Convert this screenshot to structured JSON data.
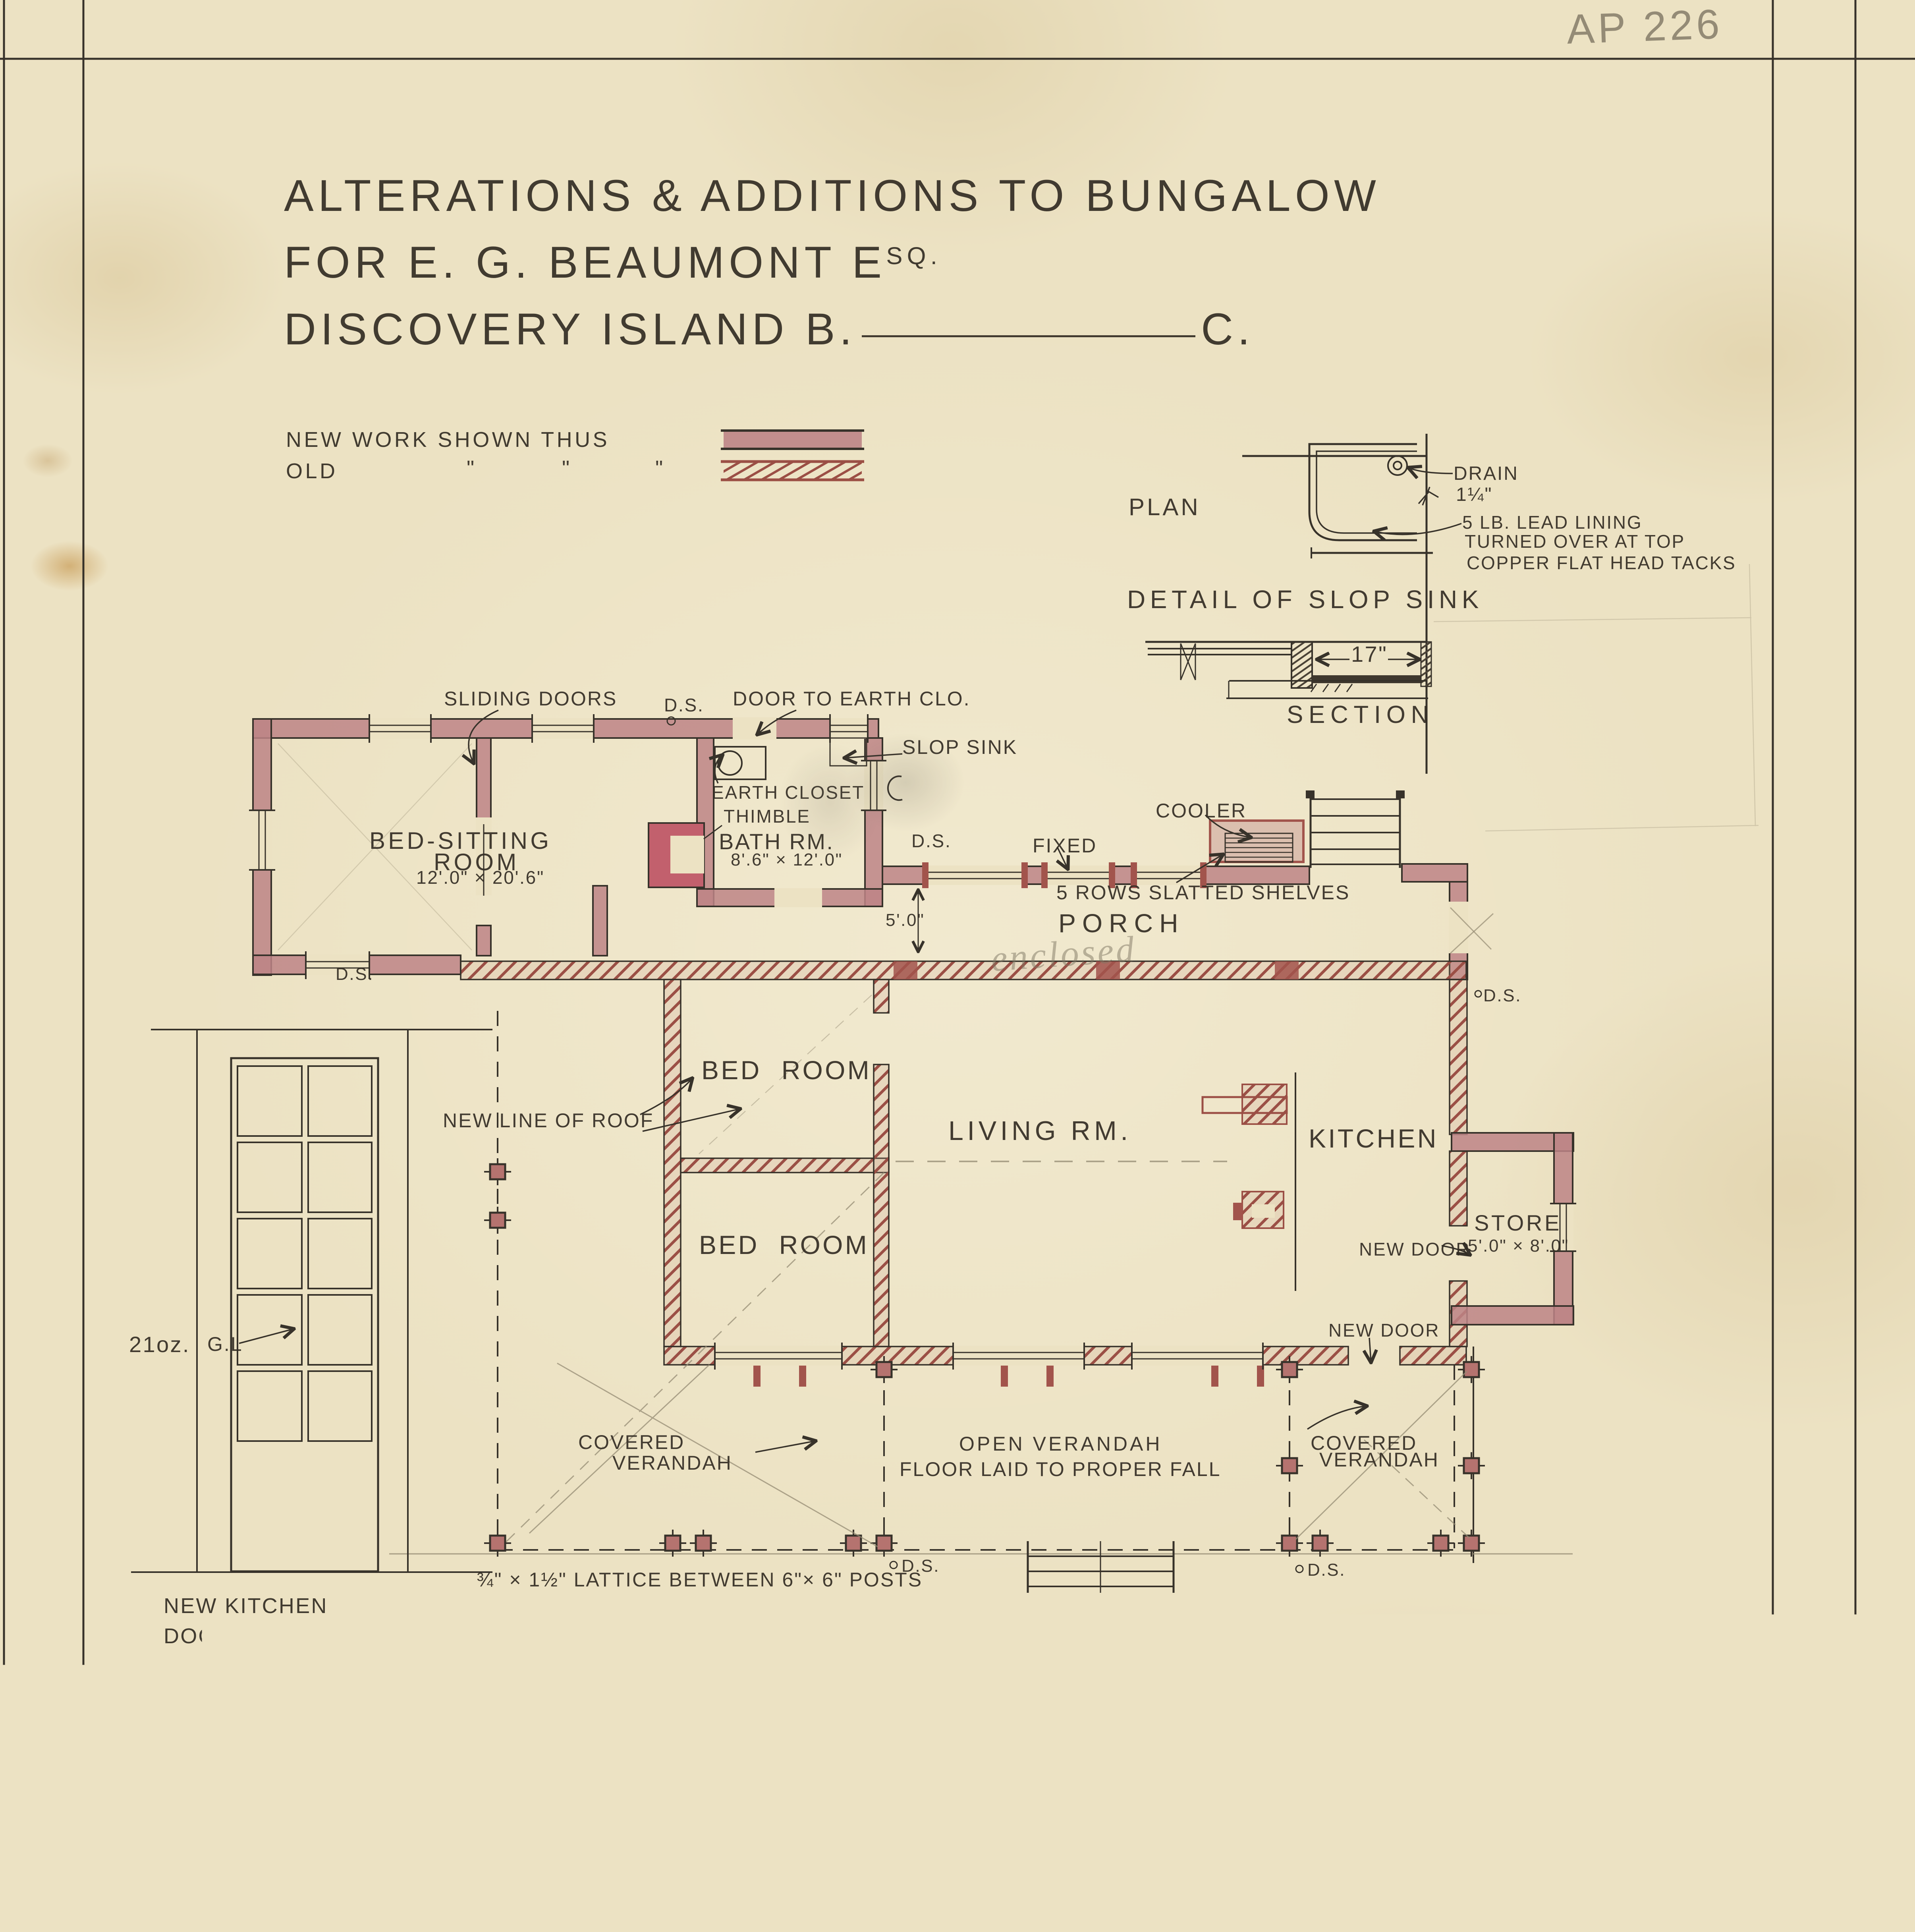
{
  "sheet": {
    "archive_no_pencil": "AP 226",
    "archive_no_stamp": "A.P. 226",
    "parks_note": "Parks Branch",
    "museum_stamp_line1": "MALTWOOD MEMORIAL MUSEUM",
    "museum_stamp_line2": "OF HISTORIC ART"
  },
  "title": {
    "line1": "ALTERATIONS & ADDITIONS TO BUNGALOW",
    "line2_main": "FOR E. G. BEAUMONT E",
    "line2_sup": "SQ.",
    "line3_left": "DISCOVERY ISLAND B.",
    "line3_right": "C."
  },
  "legend": {
    "new_label": "NEW WORK SHOWN THUS",
    "old_label": "OLD",
    "ditto": "\""
  },
  "slop_sink_detail": {
    "plan_label": "PLAN",
    "drain": "DRAIN",
    "pipe_size": "1¼\"",
    "note1": "5 LB. LEAD LINING",
    "note2": "TURNED OVER AT TOP",
    "note3": "COPPER FLAT HEAD TACKS",
    "heading": "DETAIL OF SLOP SINK",
    "width_dim": "17\"",
    "section_label": "SECTION"
  },
  "plan": {
    "sliding_doors": "SLIDING DOORS",
    "ds": "D.S.",
    "door_to_earth_closet": "DOOR TO EARTH CLO.",
    "slop_sink": "SLOP SINK",
    "earth_closet": "EARTH CLOSET",
    "thimble": "THIMBLE",
    "bed_sitting_room_1": "BED-SITTING",
    "bed_sitting_room_2": "ROOM",
    "bed_sitting_dim": "12'.0\" × 20'.6\"",
    "bath_room": "BATH RM.",
    "bath_dim": "8'.6\" × 12'.0\"",
    "fixed": "FIXED",
    "cooler": "COOLER",
    "shelves": "5 ROWS SLATTED SHELVES",
    "porch": "PORCH",
    "enclosed_note": "enclosed",
    "porch_depth_dim": "5'.0\"",
    "new_line_of_roof": "NEW LINE OF ROOF",
    "bed_room": "BED ROOM",
    "living_room": "LIVING RM.",
    "kitchen": "KITCHEN",
    "store": "STORE",
    "store_dim": "5'.0\" × 8'.0\"",
    "new_door": "NEW DOOR",
    "covered_1": "COVERED",
    "covered_2": "VERANDAH",
    "open_verandah": "OPEN VERANDAH",
    "open_verandah_note": "FLOOR LAID TO PROPER FALL",
    "lattice_note": "¾\" × 1½\" LATTICE BETWEEN 6\"× 6\" POSTS",
    "glass_weight": "21oz.",
    "glass_label": "G.L",
    "new_kitchen_door_1": "NEW KITCHEN",
    "new_kitchen_door_2": "DOOR .",
    "caption": "FLOOR PLAN ."
  },
  "footer": {
    "scale": "SCALE ⅛ INCH TO 1 FOOT.",
    "architect_line1": "S. MACLURE. ARCHITECT.",
    "architect_line2": "VICTORIA. B.C. JAN. 1922."
  },
  "colors": {
    "new_work": "#bd8486",
    "old_work_hatch": "#9b4f45",
    "ink": "#37322a",
    "pencil": "#7f7663",
    "stamp_red": "#93372f",
    "paper": "#ece2c3"
  }
}
